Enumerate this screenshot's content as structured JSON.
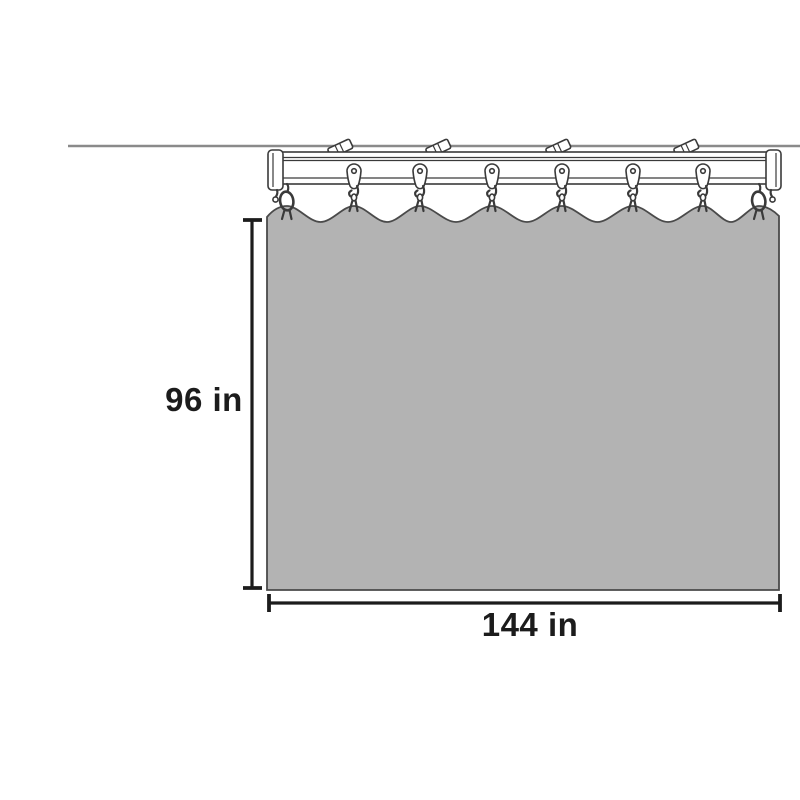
{
  "diagram": {
    "name": "Ceiling track curtain dimension diagram",
    "dimensions": {
      "height_label": "96 in",
      "width_label": "144 in",
      "height_value": 96,
      "width_value": 144,
      "unit": "in"
    },
    "hardware": {
      "mounting_bracket_count": 4,
      "glider_hook_count": 6,
      "end_stop_count": 2,
      "curtain_attachment_count": 8
    },
    "colors": {
      "background": "#ffffff",
      "ceiling_line": "#8a8a8a",
      "hardware_outline": "#3a3a3a",
      "hardware_fill": "#ffffff",
      "curtain_fill": "#b3b3b3",
      "curtain_outline": "#4a4a4a",
      "dimension_color": "#1c1c1c"
    }
  }
}
